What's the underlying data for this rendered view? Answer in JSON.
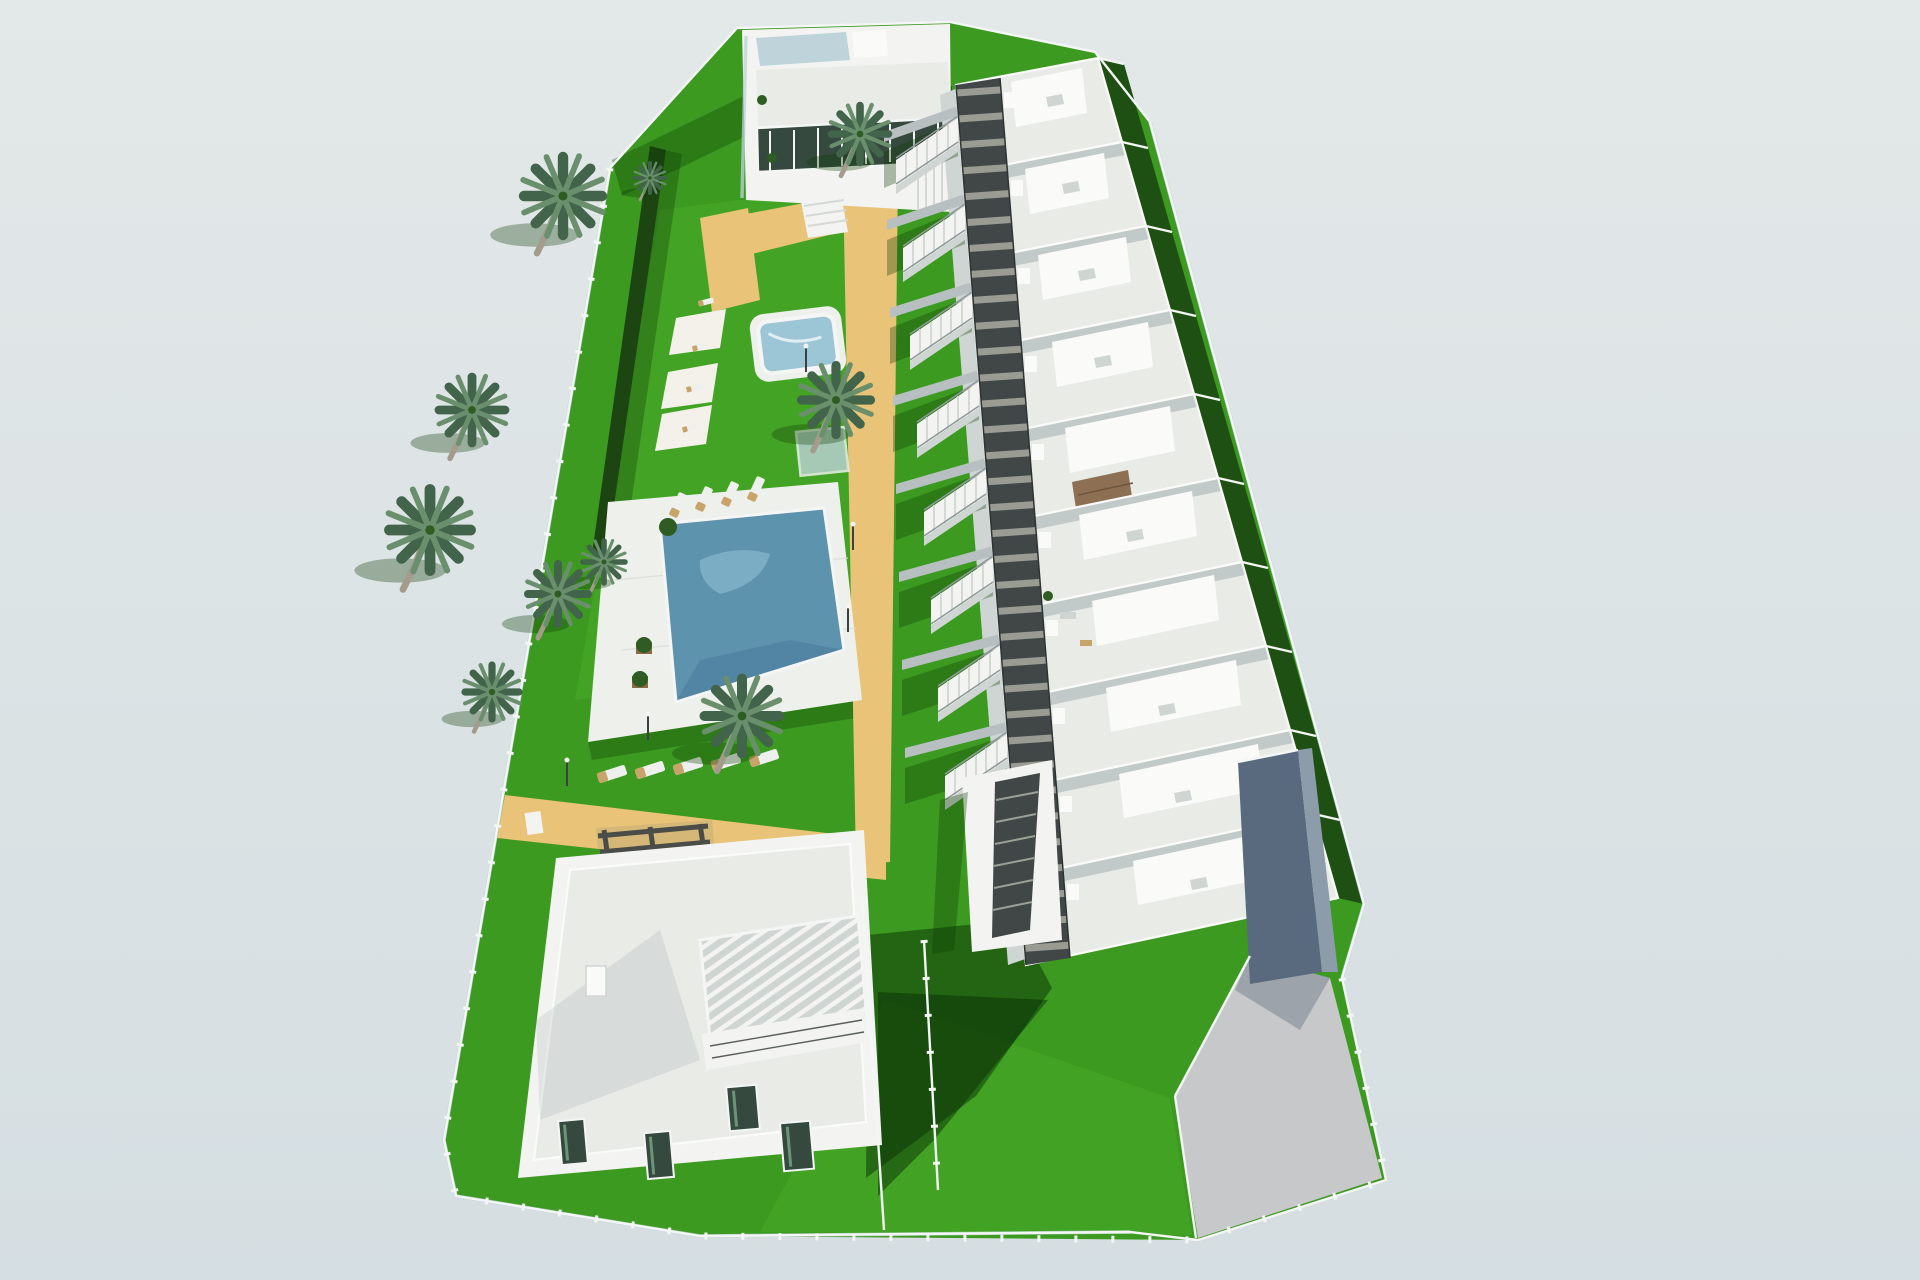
{
  "scene": {
    "type": "3d_architectural_render",
    "view": "aerial_perspective",
    "description": "Aerial 3D architectural rendering of a white residential development: a stepped row of ten flat-roofed townhouses with a dark covered walkway and external staircases, a communal garden with a large swimming pool and a small kids pool, palm trees, sun loungers, white shade sails, sand-coloured paths, a clubhouse building at the far end, a detached villa with white roof pergola at the near end, green fenced lawns and a grey driveway with garage ramp, all on a pale blue-grey backdrop."
  },
  "site": {
    "townhouse_units": 10,
    "clubhouse_buildings": 1,
    "detached_villas": 1,
    "swimming_pools": 2,
    "palm_trees": 10,
    "sun_loungers": 13,
    "shade_sails": 3,
    "features": [
      "communal garden",
      "sand coloured paths",
      "rooftop terraces",
      "brown rooftop pergola",
      "white villa roof pergola",
      "glass perimeter fence",
      "external staircases",
      "dark covered walkway",
      "driveway and garage ramp",
      "sun lounger areas",
      "hedge boundary"
    ]
  },
  "colors": {
    "sky-top": "#e3e8e8",
    "sky-bottom": "#d5dee2",
    "lawn": "#3c9a20",
    "lawn-light": "#4cb02a",
    "hedge": "#1c4512",
    "garden-dark": "#1e5013",
    "shadow-green": "rgba(10,48,5,0.50)",
    "shadow-green-soft": "rgba(14,62,7,0.33)",
    "shadow-gray": "rgba(95,115,125,0.28)",
    "sand": "#e9c377",
    "deck": "#eef0ec",
    "deck-line": "#d9dcd3",
    "roof-terrace": "#e9ebe7",
    "roof-bright": "#fafbf8",
    "wall-white": "#f3f4f1",
    "wall-shade": "#cfd5d3",
    "wall-dark": "#b7bfc1",
    "walkway": "#414747",
    "walkway-slat": "#a9aba1",
    "walk-edge": "#2e3434",
    "pool": "#5d93ac",
    "pool-light": "#8fc0d4",
    "pool-dark": "#47789b",
    "kids-pool": "#9cc6d6",
    "sail": "#f3f1ea",
    "lounger-white": "#eef0ee",
    "lounger-tan": "#c8a36a",
    "pergola-brown": "#8d7054",
    "pergola-brown-line": "#6e563f",
    "pergola-dark": "#4a4c48",
    "glass": "#bfd3da",
    "fence-white": "#f4f6f5",
    "window": "#35493e",
    "window-light": "#6b9478",
    "palm-frond": "#6a8f6d",
    "palm-frond-dark": "#42644a",
    "palm-trunk": "#a39c8d",
    "pole": "#3c4040",
    "driveway": "#c6c8c9",
    "ramp": "#5a6a7e",
    "ramp-light": "#8d9cab",
    "planter-green": "#2e5c23",
    "planter-box": "#8a6a45",
    "rail": "#8f999b",
    "step-line": "#d5d9d6",
    "step-line-dark": "#9aa096"
  }
}
